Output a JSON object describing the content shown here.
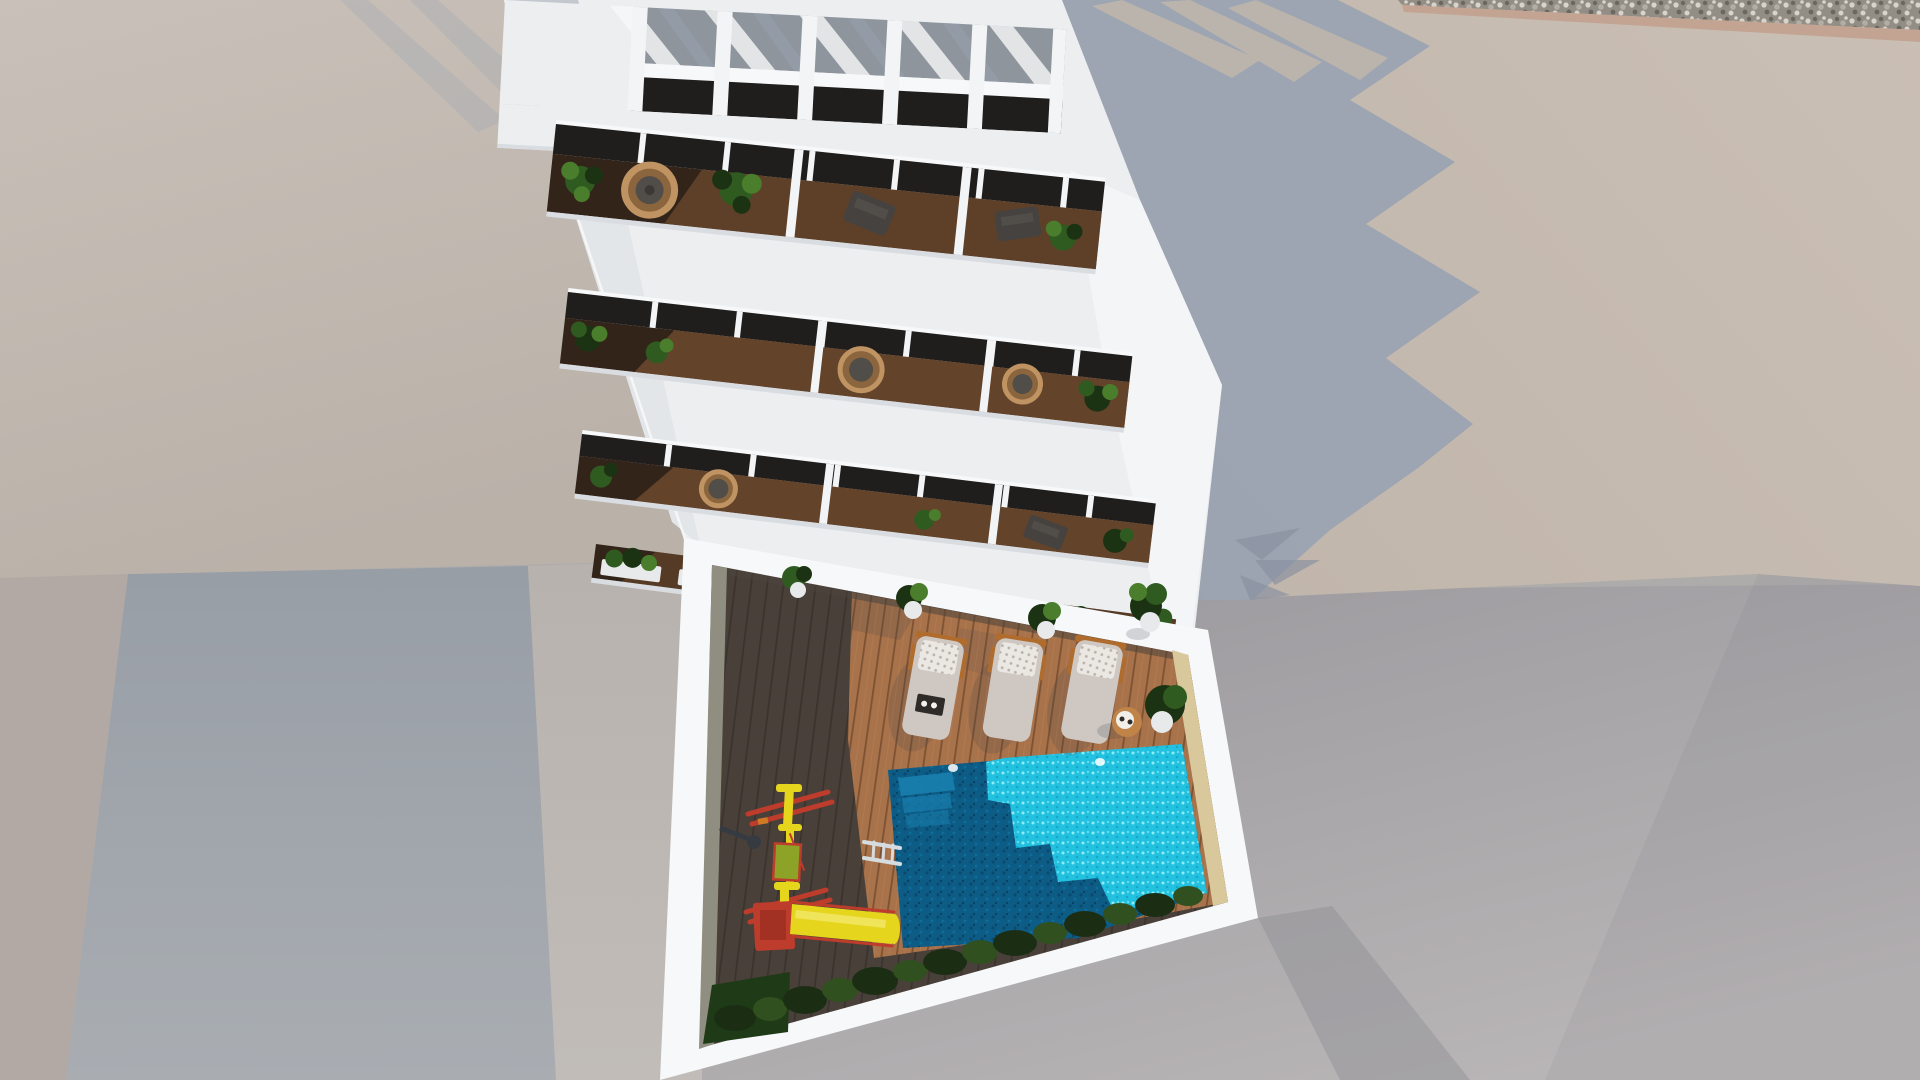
{
  "scene": {
    "description": "Aerial 3D architectural render: white apartment building with rooftop pergola, stacked plant-filled balconies and a courtyard with swimming pool, sun loungers and a yellow playground slide",
    "objects": [
      "rooftop-pergola",
      "balcony",
      "wicker-egg-chair",
      "potted-plant",
      "sun-lounger",
      "side-table",
      "swimming-pool",
      "pool-ladder",
      "playground-slide",
      "hedge-bushes",
      "wood-deck",
      "neighbor-rooftops",
      "gravel-strip",
      "cast-shadow"
    ]
  },
  "colors": {
    "bg": "#aeacab",
    "roof_left": "#c9c1b9",
    "roof_left_low": "#bab1a9",
    "strip_far_left": "#b2a9a4",
    "wall_left_top": "#989ea6",
    "wall_left_bottom": "#a9adb2",
    "ground_left": "#b8b2ae",
    "ground_left_low": "#c1bcb8",
    "ground_low_top": "#97959a",
    "ground_low_bottom": "#b8b5b6",
    "ground_dark_band": "#8e8d93",
    "roof_right": "#c1b6ac",
    "roof_right_light": "#cabfb4",
    "gravel_base": "#928d85",
    "pebble_light": "#d8d4cb",
    "pebble_mid": "#b3ada3",
    "pebble_dark": "#6b675f",
    "gravel_edge": "#c3a493",
    "shadow_right": "#9aa3b1",
    "shadow_palm": "#8a92a1",
    "building_white": "#eceef0",
    "building_bright": "#f7f8f9",
    "building_shade": "#d9dde1",
    "wall_west_shade": "#e3e6e9",
    "wall_top_shade": "#c3c8ce",
    "pergola_slot": "#8e959d",
    "pergola_stripe_shadow": "#9aa6b4",
    "glass_dark": "#201e1c",
    "wood_dark": "#33241a",
    "wood_sun": "#8a5c38",
    "wood_mid": "#5e4029",
    "plant_dark": "#1c3313",
    "plant_mid": "#2f5a20",
    "plant_light": "#4a7d2c",
    "wicker": "#c09362",
    "wicker_dark": "#8a653d",
    "seat_gray": "#514d49",
    "seat_dot": "#3b3835",
    "chair_dark": "#45423f",
    "divider_white": "#f2f4f5",
    "planter_white": "#e8e9ea",
    "deck_dark": "#4a403a",
    "deck_dark_line": "#3b332e",
    "deck_sun": "#a8724a",
    "deck_sun_line": "#7c5233",
    "deck_sun_streak": "#b98257",
    "inner_wall_left": "#8f8e80",
    "inner_wall_sun": "#d8c89b",
    "courtyard_edge_shade": "#4a443c",
    "pool_dark": "#0d5c86",
    "pool_dark_deep": "#0a4a70",
    "pool_dark_mid": "#0e6d9a",
    "pool_dark_deepest": "#07405f",
    "pool_sun": "#22c1e0",
    "pool_sparkle": "#90ecf6",
    "pool_sun_mid": "#17a8c9",
    "pool_step": "#1a7fae",
    "pool_light": "#ffffff",
    "bush_dark": "#1b2e14",
    "bush_mid": "#30501f",
    "grass": "#1e3a16",
    "lounger_body": "#cfc8c2",
    "lounger_pillow": "#ebe7e2",
    "pillow_dot": "#b9b2aa",
    "lounger_frame": "#b06c2c",
    "tray_dark": "#2e2b29",
    "tray_white": "#f4f2ee",
    "table_top": "#c08449",
    "table_plate": "#f2efe9",
    "slide_yellow": "#e6d51d",
    "slide_yellow_hi": "#f2e96a",
    "slide_red": "#bd3c2b",
    "slide_red_dark": "#8f2a1e",
    "mat_green": "#8da327",
    "play_orange": "#d07a24",
    "ladder": "#d5dbdf",
    "shower_dark": "#363b41",
    "shadow_soft": "#3c4250"
  }
}
